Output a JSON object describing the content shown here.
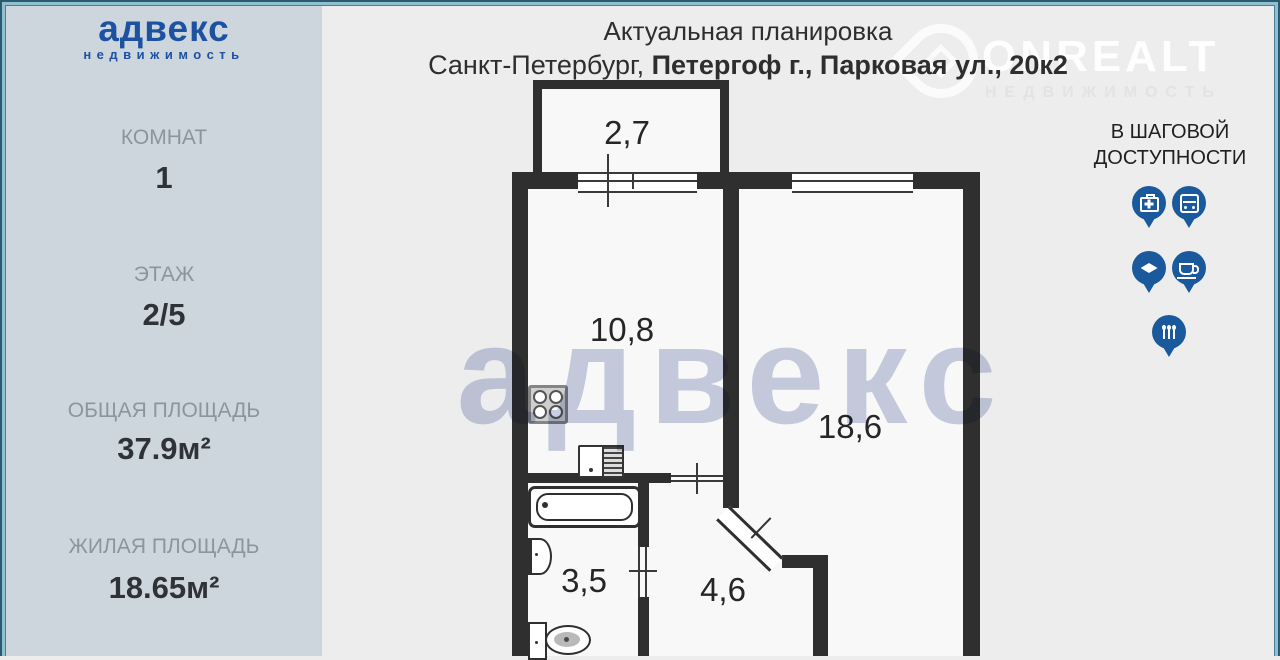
{
  "header": {
    "title": "Актуальная планировка",
    "address_prefix": "Санкт-Петербург, ",
    "address_emphasis": "Петергоф г., Парковая ул., 20к2"
  },
  "sidebar": {
    "brand": "адвекс",
    "brand_sub": "недвижимость",
    "stats": [
      {
        "label": "КОМНАТ",
        "value": "1"
      },
      {
        "label": "ЭТАЖ",
        "value": "2/5"
      },
      {
        "label": "ОБЩАЯ ПЛОЩАДЬ",
        "value": "37.9м²"
      },
      {
        "label": "ЖИЛАЯ ПЛОЩАДЬ",
        "value": "18.65м²"
      }
    ]
  },
  "watermarks": {
    "advex": "адвекс",
    "onrealt": "ONREALT",
    "onrealt_sub": "НЕДВИЖИМОСТЬ"
  },
  "nearby": {
    "heading_line1": "В ШАГОВОЙ",
    "heading_line2": "ДОСТУПНОСТИ",
    "pins": [
      "first-aid",
      "bus",
      "education",
      "cafe",
      "restaurant"
    ],
    "pin_color": "#1a5a9c"
  },
  "plan": {
    "rooms": [
      {
        "name": "balcony",
        "area": "2,7"
      },
      {
        "name": "kitchen",
        "area": "10,8"
      },
      {
        "name": "living-room",
        "area": "18,6"
      },
      {
        "name": "bathroom",
        "area": "3,5"
      },
      {
        "name": "hallway",
        "area": "4,6"
      }
    ]
  },
  "colors": {
    "accent_blue": "#1d52a3",
    "pin_blue": "#1a5a9c",
    "wall": "#2f2f2f",
    "sidebar_bg": "#cdd6dd",
    "canvas_bg": "#ededed"
  }
}
